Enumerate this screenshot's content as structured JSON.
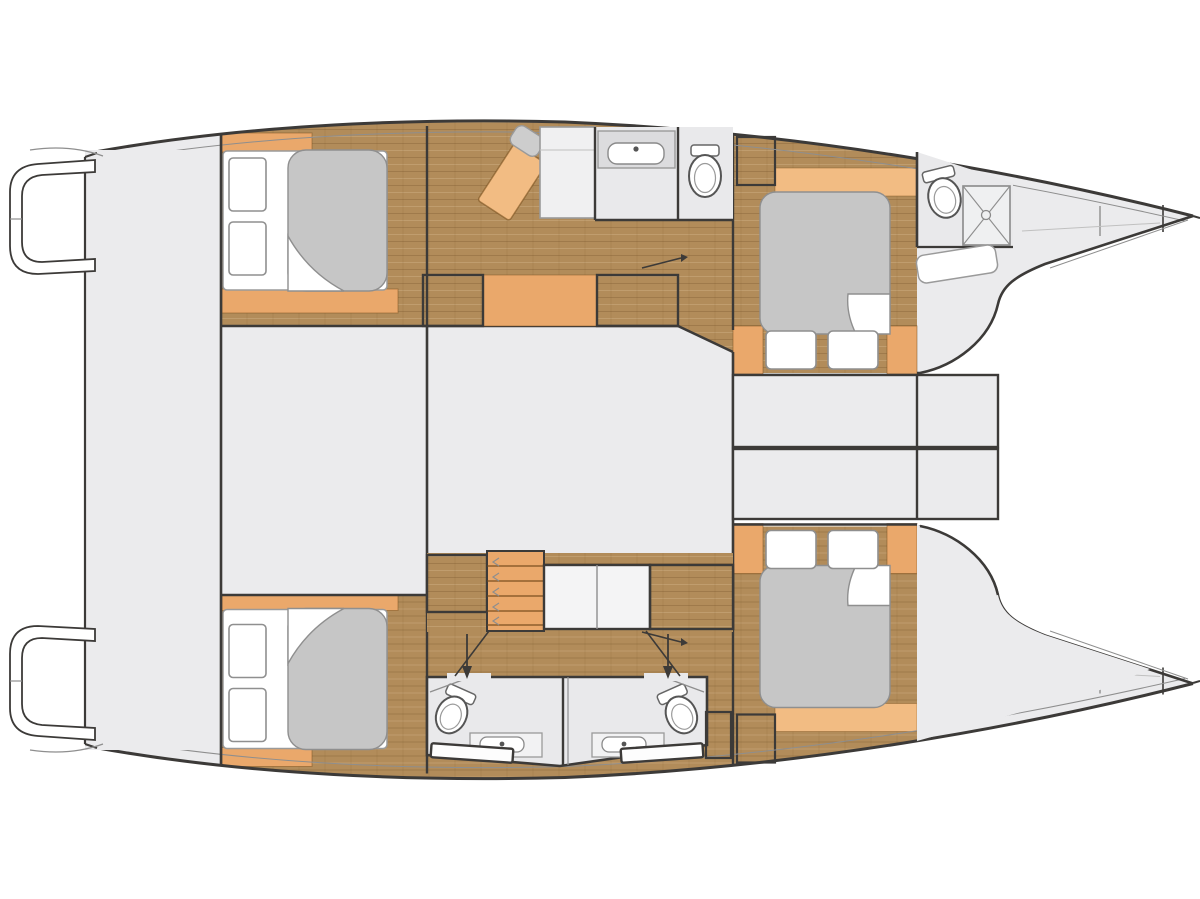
{
  "figure": {
    "kind": "boat-floor-plan",
    "vessel": "catamaran",
    "view": "top-down deck plan",
    "orientation": {
      "bow": "right",
      "stern": "left"
    },
    "canvas": {
      "width": 1200,
      "height": 899
    }
  },
  "palette": {
    "bg": "#ffffff",
    "deck": "#ebebed",
    "deckline": "#d7d7d9",
    "bath": "#e9e9eb",
    "counter": "#dcdcde",
    "wood": "#b28c5a",
    "woodDark": "#8f6c3e",
    "orange": "#eaa86b",
    "orangeLight": "#f2bc83",
    "mattress": "#c6c6c6",
    "seatGray": "#cdcdcd",
    "fixture": "#ffffff",
    "outline": "#3c3a38",
    "mid": "#8e8e8e",
    "light": "#c0c0c0",
    "hatch": "#9b9b9b"
  },
  "inventory": {
    "hulls": 2,
    "double_beds": 4,
    "pillows": 8,
    "cabins": 4,
    "bathrooms": 3,
    "toilets": 4,
    "sinks": 3,
    "shower_stalls": 1,
    "wardrobes": 8,
    "staircases": 1,
    "swim_platforms": 2,
    "door_arrows": 2,
    "trampoline_areas": 1
  },
  "legend": {
    "port-hull": "upper hull with aft cabin, nav/galley area, bathroom, forward cabin and forward bathroom",
    "starboard-hull": "lower hull with aft cabin, twin bathrooms and forward cabin",
    "saloon": "central bridge-deck saloon (plain floor)",
    "aft-platform": "stern platform joining both transoms",
    "swim-steps": "transom swim steps on each hull",
    "wardrobe": "hatched rectangle = hanging locker",
    "staircase": "companionway steps from saloon down into hull",
    "shower": "square with X = shower tray",
    "door-arrow": "arrow marking door entry into bathroom",
    "trampoline": "open bow area between hull tips"
  }
}
